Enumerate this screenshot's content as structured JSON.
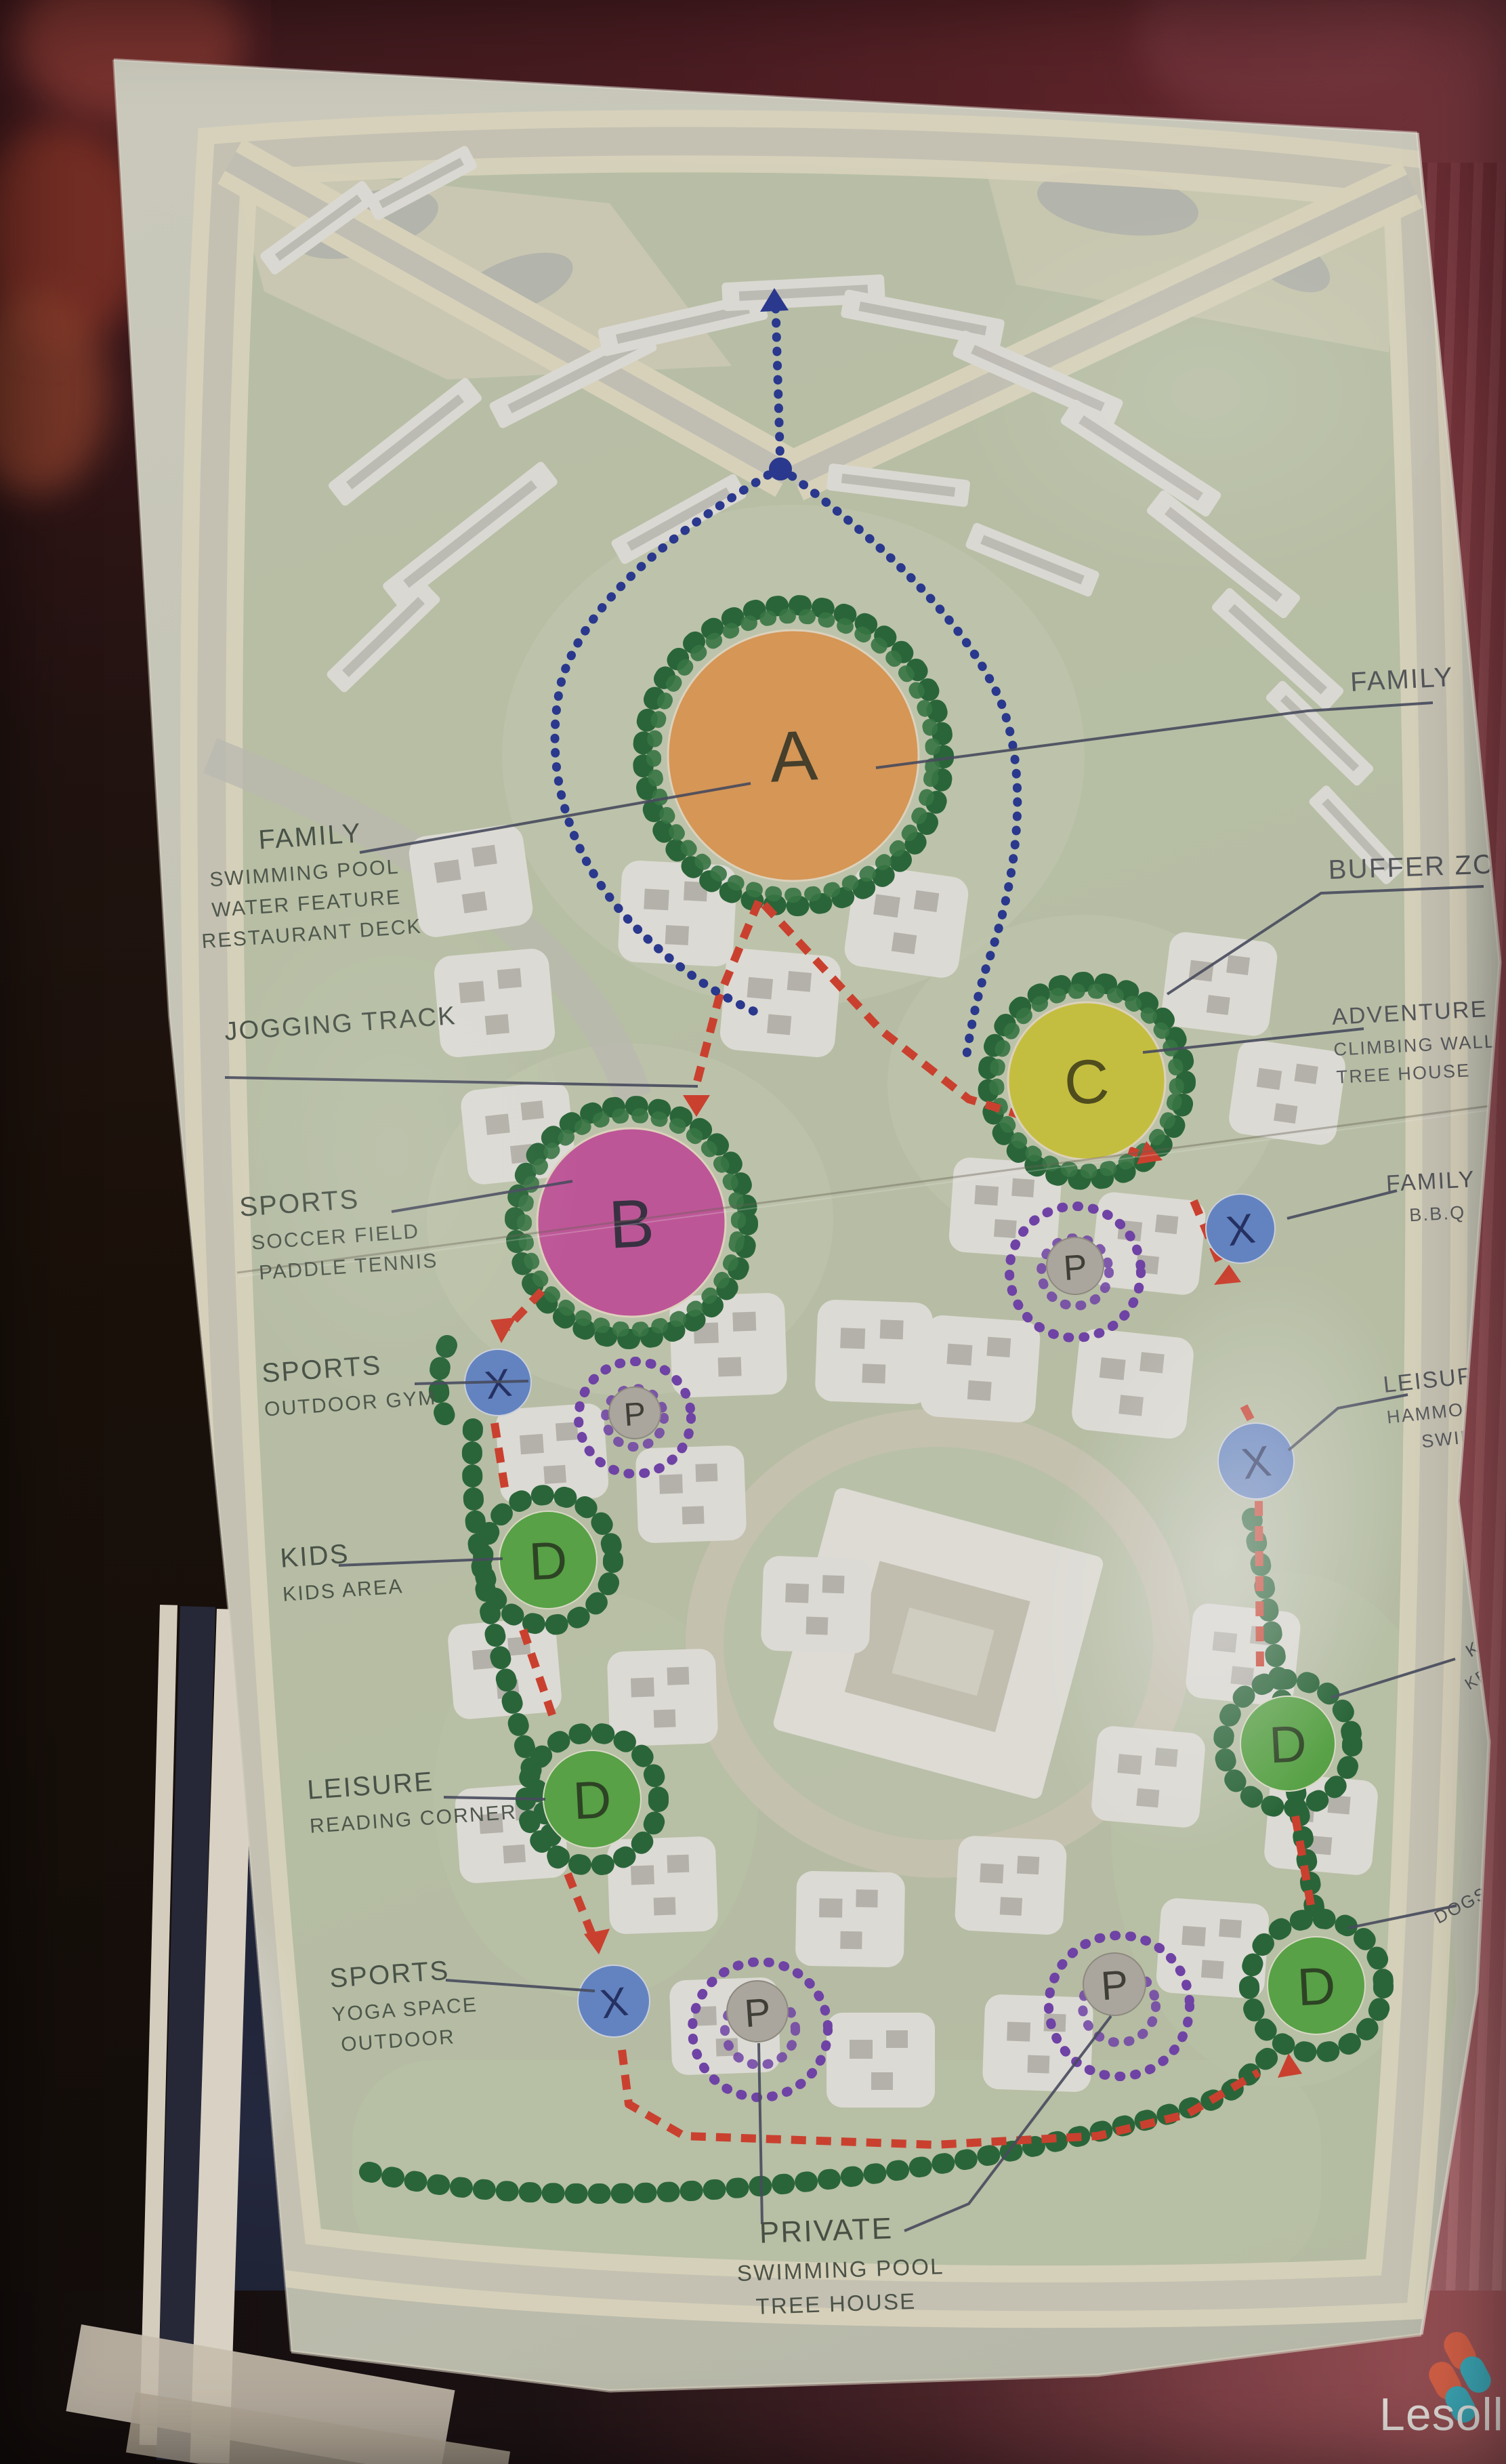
{
  "watermark": {
    "text": "Lesoll",
    "logo_colors": {
      "orange": "#e4674b",
      "teal": "#3fb4c4"
    }
  },
  "map": {
    "zone_letters": {
      "a": "A",
      "b": "B",
      "c": "C",
      "d": "D",
      "x": "X",
      "p": "P"
    },
    "colors": {
      "zone_a": "#eaa55e",
      "zone_b": "#d05ea6",
      "zone_c": "#d7d246",
      "zone_d": "#5fb24c",
      "marker_x": "#6b90d4",
      "marker_p": "#7948b6",
      "route_jogging": "#de4633",
      "route_pedestrian": "#2c3d9b",
      "trees": "#2c6f3e"
    }
  },
  "labels": {
    "family_pool": {
      "title": "FAMILY",
      "line1": "SWIMMING POOL",
      "line2": "WATER FEATURE",
      "line3": "RESTAURANT DECK"
    },
    "jogging_track": {
      "title": "JOGGING TRACK"
    },
    "sports_soccer": {
      "title": "SPORTS",
      "line1": "SOCCER FIELD",
      "line2": "PADDLE TENNIS"
    },
    "sports_gym": {
      "title": "SPORTS",
      "line1": "OUTDOOR GYM"
    },
    "kids": {
      "title": "KIDS",
      "line1": "KIDS AREA"
    },
    "leisure_reading": {
      "title": "LEISURE",
      "line1": "READING CORNER"
    },
    "sports_yoga": {
      "title": "SPORTS",
      "line1": "YOGA SPACE",
      "line2": "OUTDOOR"
    },
    "private_pool": {
      "title": "PRIVATE",
      "line1": "SWIMMING POOL",
      "line2": "TREE HOUSE"
    },
    "family_right": {
      "title": "FAMILY"
    },
    "buffer_zone": {
      "title": "BUFFER ZONE"
    },
    "adventure": {
      "title": "ADVENTURE",
      "line1": "CLIMBING WALL",
      "line2": "TREE HOUSE"
    },
    "family_bbq": {
      "title": "FAMILY",
      "line1": "B.B.Q"
    },
    "leisure_hammock": {
      "title": "LEISURE",
      "line1": "HAMMOCK",
      "line2": "SWING"
    },
    "edge_cut_kids": {
      "title": "KI",
      "line1": "KEN"
    },
    "edge_cut_dogs": {
      "title": "DOGS"
    }
  }
}
